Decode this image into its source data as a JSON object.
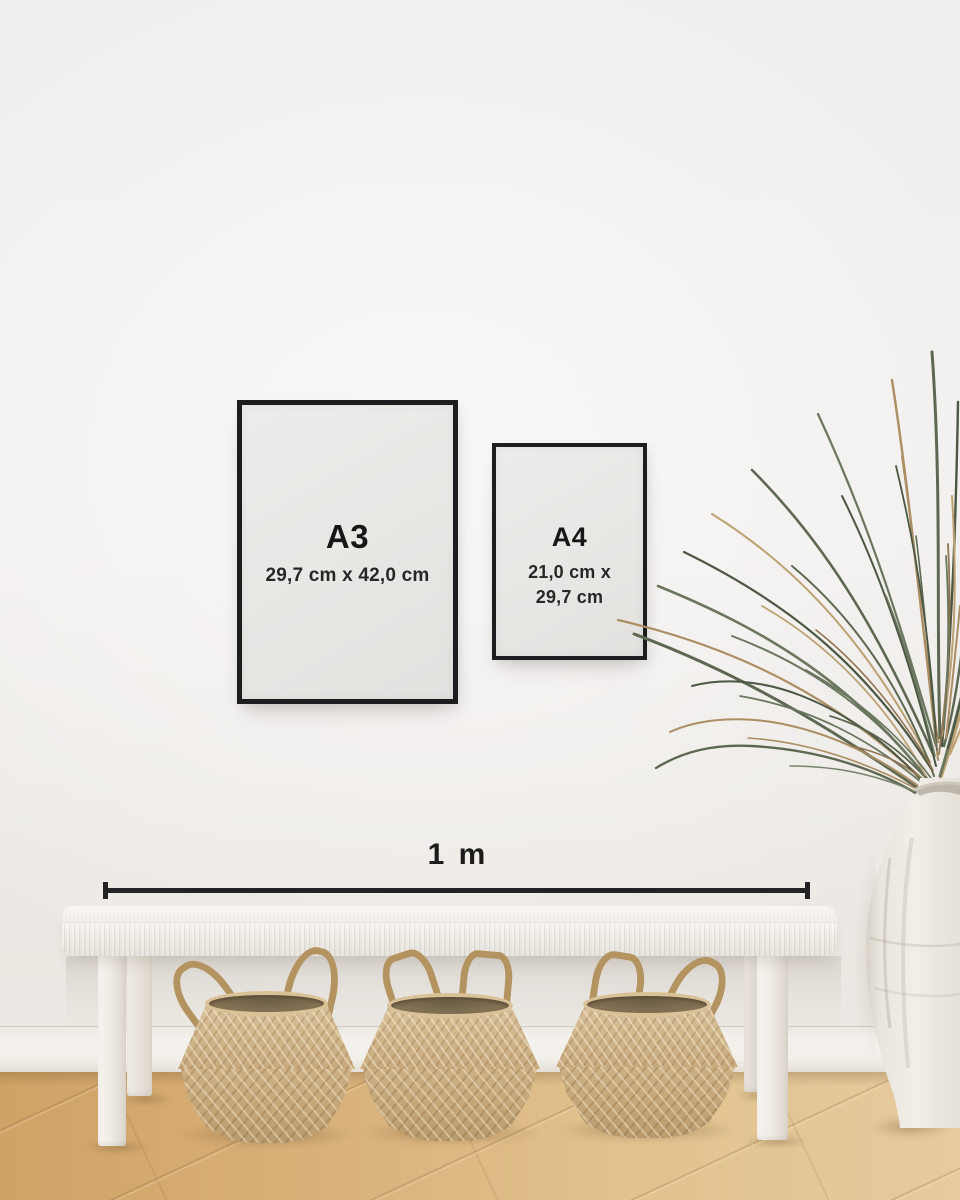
{
  "frames": {
    "a3": {
      "label": "A3",
      "dimensions": "29,7 cm x 42,0 cm"
    },
    "a4": {
      "label": "A4",
      "dimensions_line1": "21,0 cm x",
      "dimensions_line2": "29,7 cm"
    }
  },
  "scale": {
    "label": "1 m"
  },
  "colors": {
    "frame_border": "#1d1d1f",
    "text": "#171717",
    "wall": "#f0eeec",
    "bench": "#f4f1ed",
    "basket": "#c4a678",
    "plant_green": "#5d6852",
    "plant_tan": "#ab8e63",
    "vase": "#ece8e1"
  }
}
